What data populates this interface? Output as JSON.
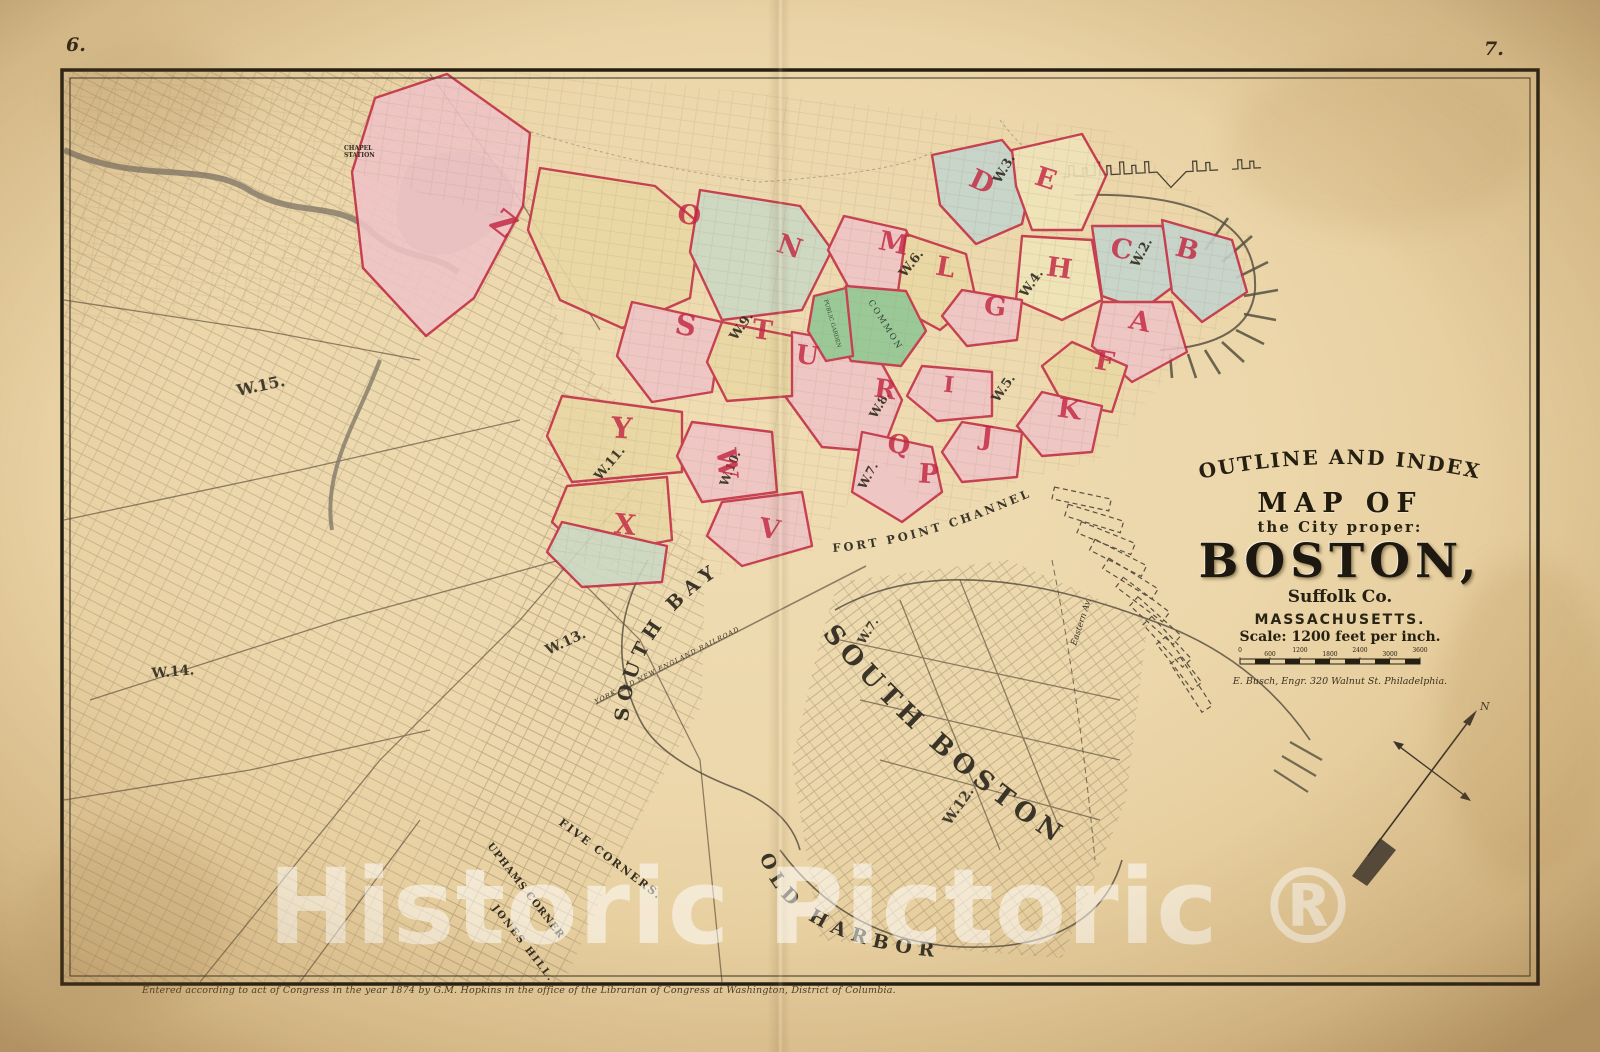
{
  "page": {
    "left_number": "6.",
    "right_number": "7.",
    "copyright": "Entered according to act of Congress in the year 1874 by G.M. Hopkins in the office of the Librarian of Congress at Washington, District of Columbia.",
    "watermark": "Historic Pictoric ®"
  },
  "cartouche": {
    "arc_title": "OUTLINE AND INDEX",
    "map_of": "MAP OF",
    "subtitle": "the City proper:",
    "city": "BOSTON,",
    "county": "Suffolk Co.",
    "state": "MASSACHUSETTS.",
    "scale_text": "Scale: 1200 feet per inch.",
    "scale_ticks": [
      "0",
      "600",
      "1200",
      "1800",
      "2400",
      "3000",
      "3600"
    ],
    "engraver": "E. Busch, Engr. 320 Walnut St. Philadelphia."
  },
  "compass": {
    "north": "N"
  },
  "wards": {
    "red": [
      "Z",
      "O",
      "N",
      "M",
      "L",
      "D",
      "E",
      "H",
      "C",
      "B",
      "A",
      "G",
      "F",
      "I",
      "K",
      "J",
      "P",
      "Q",
      "R",
      "S",
      "T",
      "U",
      "V",
      "W",
      "X",
      "Y"
    ],
    "black": [
      "W.2.",
      "W.3.",
      "W.4.",
      "W.5.",
      "W.6.",
      "W.7.",
      "W.7.",
      "W.8.",
      "W.9.",
      "W.10.",
      "W.11.",
      "W.12.",
      "W.13.",
      "W.14.",
      "W.15."
    ]
  },
  "labels": {
    "water": [
      "SOUTH BAY",
      "FORT POINT CHANNEL",
      "OLD HARBOR"
    ],
    "district": "SOUTH BOSTON",
    "railroad": "YORK AND NEW ENGLAND RAILROAD",
    "places": [
      "CHAPEL",
      "STATION",
      "FIVE CORNERS.",
      "UPHAMS CORNER",
      "JONES HILL.",
      "COMMON",
      "PUBLIC GARDEN",
      "Eastern Av."
    ]
  },
  "colors": {
    "parchment": "#ecd7ab",
    "ward_pink": "#eec3c6",
    "ward_yellow": "#e9d8a3",
    "ward_cream": "#f0e4ba",
    "ward_green": "#8fc793",
    "ward_sage": "#cbd9c4",
    "ward_blue": "#c3d4cd",
    "boundary_crimson": "#c12b45",
    "ink": "#332d22"
  }
}
